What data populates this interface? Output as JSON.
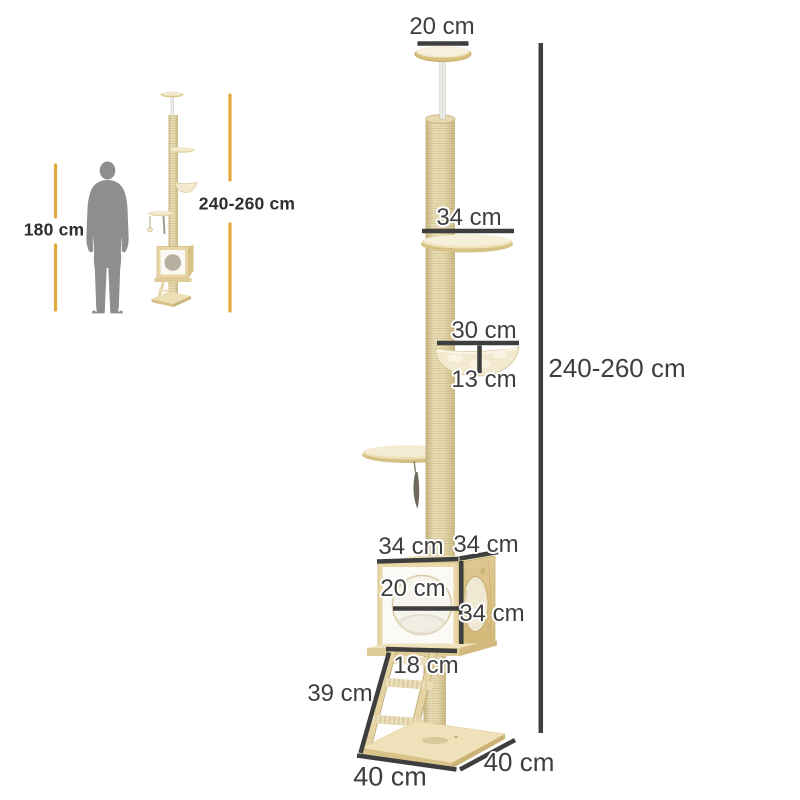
{
  "reference": {
    "human_height": "180 cm",
    "tree_height": "240-260 cm"
  },
  "dimensions": {
    "total_height": "240-260 cm",
    "top_mount": "20 cm",
    "platform_width": "34 cm",
    "hammock_width": "30 cm",
    "hammock_depth": "13 cm",
    "house_width": "34 cm",
    "house_depth": "34 cm",
    "house_hole_diameter": "20 cm",
    "house_height": "34 cm",
    "ladder_width": "18 cm",
    "ladder_length": "39 cm",
    "base_width": "40 cm",
    "base_depth": "40 cm"
  },
  "colors": {
    "background": "#FFFFFF",
    "accent_yellow": "#E2A93C",
    "dimension_line": "#3E3E3E",
    "label_text": "#3E3E3E",
    "silhouette_gray": "#8E8E8E",
    "wood_light": "#F2EAD2",
    "wood_mid": "#E6D3A0",
    "wood_dark": "#D3BC7F",
    "sisal": "#E4D6AA",
    "panel_white": "#FBFAF5",
    "hammock_cream": "#F2E9CE"
  }
}
